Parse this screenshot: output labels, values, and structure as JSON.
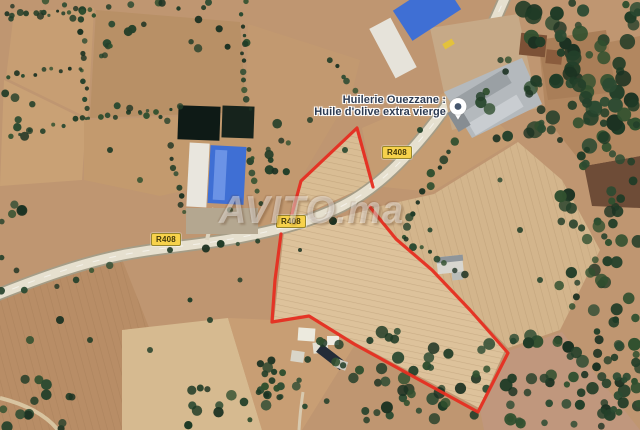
{
  "map": {
    "type": "satellite-imagery",
    "poi": {
      "name_line1": "Huilerie Ouezzane :",
      "name_line2": "Huile d'olive extra vierge"
    },
    "road_labels": [
      "R408",
      "R408",
      "R408"
    ],
    "watermark": "AVITO.ma",
    "colors": {
      "boundary_red": "#e62e21",
      "road_label_bg": "#f7d24b",
      "poi_text": "#2d3b52",
      "watermark_color": "rgba(255,255,255,0.42)"
    }
  }
}
